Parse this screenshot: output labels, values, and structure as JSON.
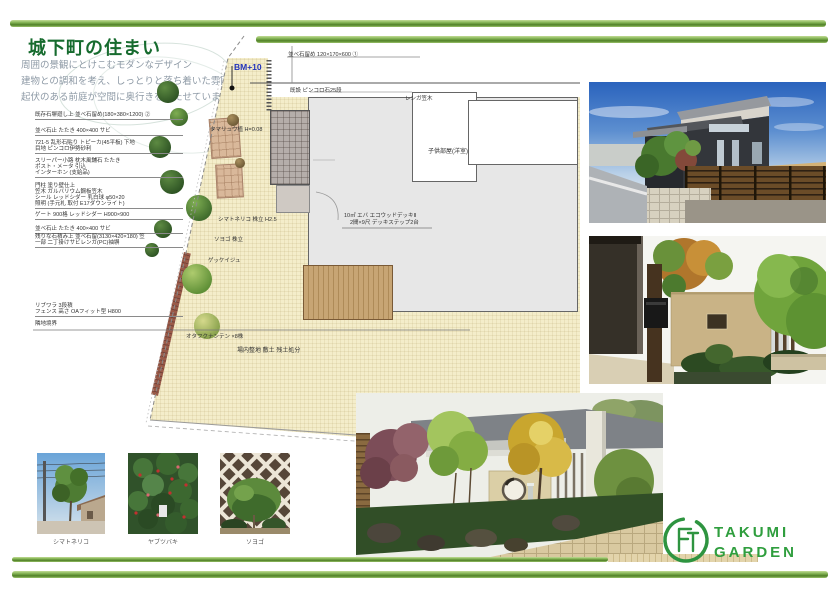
{
  "colors": {
    "accent_green": "#5a9130",
    "title_green": "#166b2e",
    "bm_blue": "#2233bb",
    "logo_green": "#2e9440"
  },
  "header": {
    "title": "城下町の住まい",
    "intro": [
      "周囲の景観にとけこむモダンなデザイン",
      "建物との調和を考え、しっとりと落ち着いた雰囲気に、",
      "起伏のある前庭が空間に奥行きを持たせています。"
    ]
  },
  "plan": {
    "bm_label": "BM+10",
    "top_note": "並べ石留め 120×170×600 ①",
    "pincoro_note": "既設 ピンコロ石25段",
    "brick_cap_note": "レンガ笠木",
    "room_label": "子供部屋(洋室)",
    "deck_note_1": "10㎡ エバ エコウッドデッキⅡ",
    "deck_note_2": "2間×9尺 デッキステップ2台",
    "ground_note": "場内整地 敷土 残土処分",
    "plant_labels": [
      "タマリュウ植 H=0.08",
      "シマトネリコ 株立 H2.5",
      "ソヨゴ 株立",
      "ゲッケイジュ",
      "オタフクナンテン ×8株"
    ],
    "notes": [
      "既存石塀廻し上 並べ石留め(180×380×1200) ②",
      "並べ石止 たたき 400×400 サビ",
      "721-5 乱形石貼り トピーカ(45平板) 下地",
      "目地 ピンコロ伊勢砂利",
      "スリーパー小路 枕木風舗石 たたき",
      "ポスト・メータ 引込",
      "インターホン (支給品)",
      "門柱 塗り壁仕上",
      "笠木 ガルバリウム鋼板笠木",
      "シール レッドシダー 乳白球 φ50×20",
      "照明 (手元札 取付 E17ダウンライト)",
      "ゲート 900格 レッドシダー H900×900",
      "並べ石止 たたき 400×400 サビ",
      "残りな石積み上 並べ石留(3130×420×180) 笠",
      "一部 二丁掛けサビレンガ(PC)袖塀",
      "リブワラ 3段積",
      "フェンス 高さ OAフィット型 H800",
      "隣地境界"
    ]
  },
  "photos": {
    "plant_captions": [
      "シマトネリコ",
      "ヤブツバキ",
      "ソヨゴ"
    ]
  },
  "logo": {
    "monogram": "FT",
    "line1": "TAKUMI",
    "line2": "GARDEN"
  }
}
